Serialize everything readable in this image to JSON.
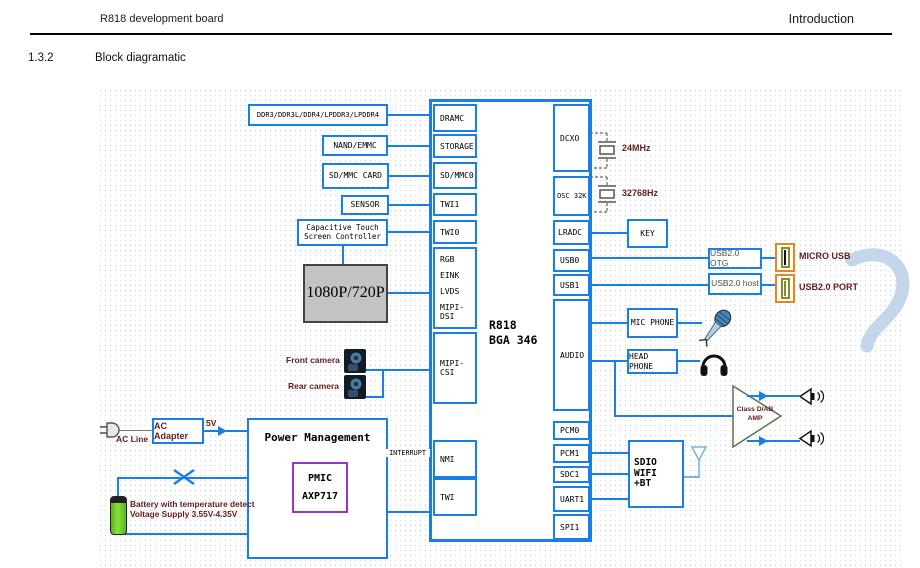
{
  "header": {
    "left": "R818 development board",
    "right": "Introduction"
  },
  "section": {
    "number": "1.3.2",
    "title": "Block diagramatic"
  },
  "chip": {
    "name_line1": "R818",
    "name_line2": "BGA 346",
    "left_ports": [
      "DRAMC",
      "STORAGE",
      "SD/MMC0",
      "TWI1",
      "TWI0"
    ],
    "display_ports": [
      "RGB",
      "EINK",
      "LVDS",
      "MIPI-DSI"
    ],
    "csi_port": "MIPI-CSI",
    "nmi_port": "NMI",
    "twi_port": "TWI",
    "right_ports_top": [
      "DCXO",
      "OSC 32K",
      "LRADC",
      "USB0",
      "USB1"
    ],
    "audio_port": "AUDIO",
    "right_ports_bottom": [
      "PCM0",
      "PCM1",
      "SDC1",
      "UART1",
      "SPI1"
    ]
  },
  "left_blocks": {
    "dram": "DDR3/DDR3L/DDR4/LPDDR3/LPDDR4",
    "nand": "NAND/EMMC",
    "sd_card": "SD/MMC CARD",
    "sensor": "SENSOR",
    "touch_line1": "Capacitive Touch",
    "touch_line2": "Screen Controller",
    "display": "1080P/720P",
    "front_camera": "Front camera",
    "rear_camera": "Rear camera"
  },
  "power": {
    "ac_line": "AC Line",
    "ac_adapter": "AC Adapter",
    "rail": "5V",
    "pm_title": "Power Management",
    "pmic_line1": "PMIC",
    "pmic_line2": "AXP717",
    "battery_line1": "Battery with temperature detect",
    "battery_line2": "Voltage Supply 3.55V-4.35V",
    "interrupt": "INTERRUPT"
  },
  "clocks": {
    "xtal_24m": "24MHz",
    "xtal_32k": "32768Hz"
  },
  "right_blocks": {
    "key": "KEY",
    "usb_otg": "USB2.0 OTG",
    "usb_host": "USB2.0 host",
    "micro_usb": "MICRO USB",
    "usb_port": "USB2.0 PORT",
    "mic": "MIC PHONE",
    "headphone": "HEAD PHONE",
    "amp_line1": "Class D/AB",
    "amp_line2": "AMP",
    "sdio_line1": "SDIO WIFI",
    "sdio_line2": "+BT"
  },
  "icons": {
    "ac_plug": "ac-plug-icon",
    "battery": "battery-icon",
    "front_camera": "camera-icon",
    "rear_camera": "camera-icon",
    "microphone": "microphone-icon",
    "headphones": "headphones-icon",
    "speaker": "speaker-icon",
    "antenna": "antenna-icon",
    "crystal": "crystal-icon",
    "usb_connector": "usb-connector-icon"
  },
  "colors": {
    "line_blue": "#1a7ee8",
    "label_maroon": "#651c1c",
    "connector_orange": "#e8871a",
    "connector_olive": "#8a8a2a",
    "pmic_purple": "#9933cc",
    "display_gray": "#c3c3c3",
    "battery_green": "#76d22a",
    "antenna_blue": "#7fb3e0",
    "amp_green": "#5a7050",
    "watermark_blue": "#c3d6ea"
  }
}
